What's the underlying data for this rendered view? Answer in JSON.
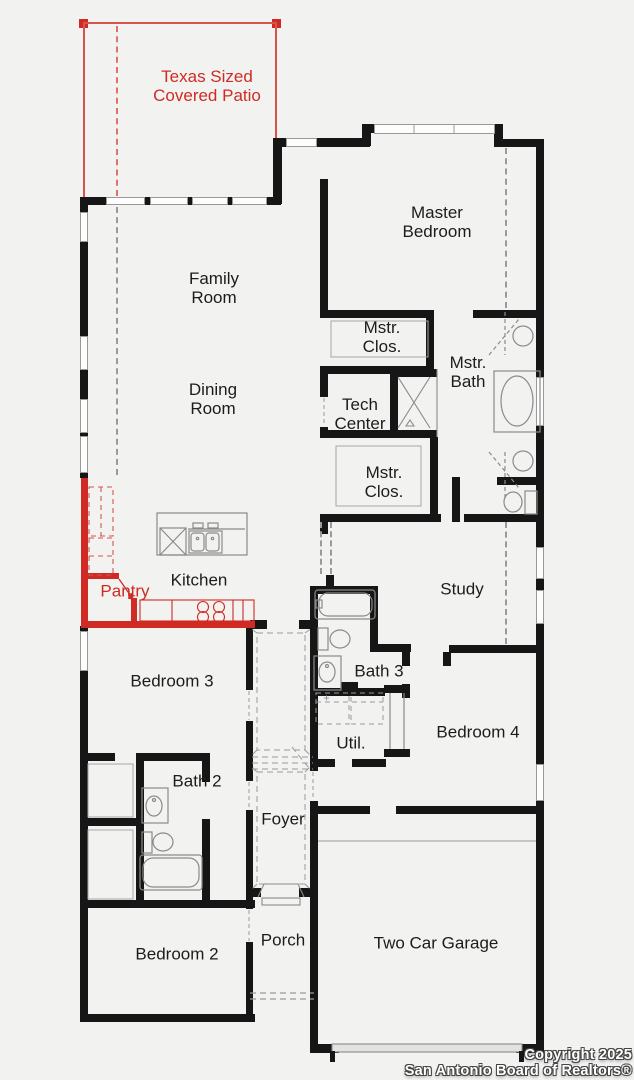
{
  "colors": {
    "background": "#f2f2f0",
    "wall": "#161616",
    "accent_red": "#cf2b24",
    "fixture": "#8a8a8a",
    "label": "#1c1c1c"
  },
  "rooms": {
    "patio": {
      "label": "Texas Sized\nCovered Patio"
    },
    "family": {
      "label": "Family\nRoom"
    },
    "dining": {
      "label": "Dining\nRoom"
    },
    "master_bedroom": {
      "label": "Master\nBedroom"
    },
    "master_closet_1": {
      "label": "Mstr.\nClos."
    },
    "master_bath": {
      "label": "Mstr.\nBath"
    },
    "tech_center": {
      "label": "Tech\nCenter"
    },
    "master_closet_2": {
      "label": "Mstr.\nClos."
    },
    "kitchen": {
      "label": "Kitchen"
    },
    "pantry": {
      "label": "Pantry"
    },
    "study": {
      "label": "Study"
    },
    "bath_3": {
      "label": "Bath 3"
    },
    "util": {
      "label": "Util."
    },
    "bedroom_4": {
      "label": "Bedroom 4"
    },
    "bedroom_3": {
      "label": "Bedroom 3"
    },
    "bath_2": {
      "label": "Bath 2"
    },
    "foyer": {
      "label": "Foyer"
    },
    "bedroom_2": {
      "label": "Bedroom 2"
    },
    "porch": {
      "label": "Porch"
    },
    "garage": {
      "label": "Two Car Garage"
    }
  },
  "copyright": {
    "line1": "Copyright 2025",
    "line2": "San Antonio Board of Realtors®"
  }
}
